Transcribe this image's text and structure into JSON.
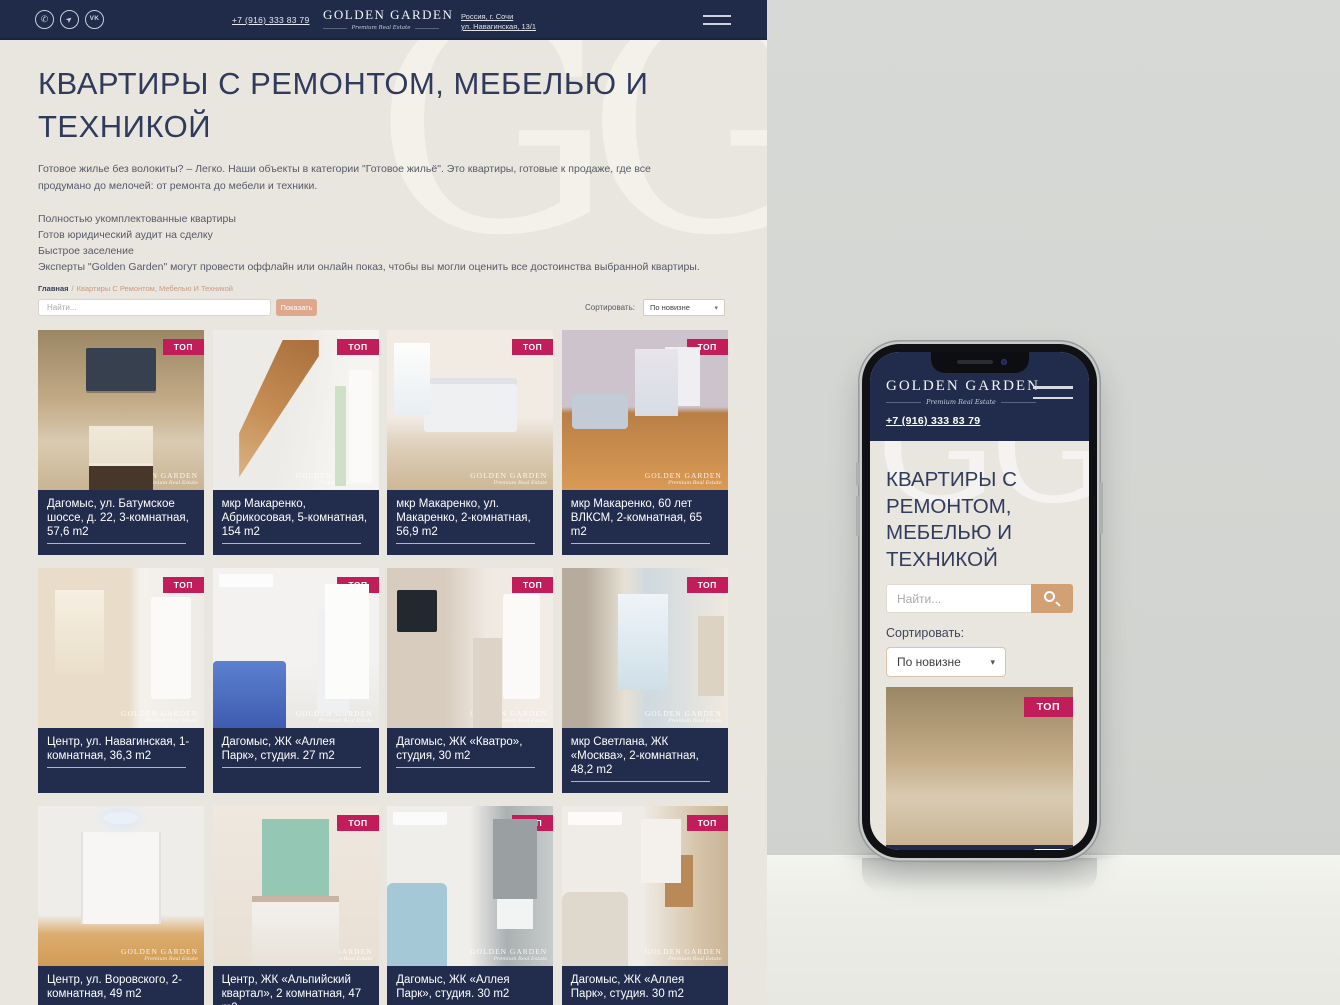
{
  "header": {
    "phone": "+7 (916) 333 83 79",
    "logo_title": "GOLDEN GARDEN",
    "logo_subtitle": "Premium Real Estate",
    "address_line1": "Россия, г. Сочи",
    "address_line2": "ул. Навагинская, 13/1",
    "social": [
      {
        "name": "whatsapp-icon",
        "glyph": "✆"
      },
      {
        "name": "telegram-icon",
        "glyph": "➤"
      },
      {
        "name": "vk-icon",
        "glyph": "VK"
      }
    ]
  },
  "watermark": {
    "letters": "GG"
  },
  "page": {
    "title": "КВАРТИРЫ С РЕМОНТОМ, МЕБЕЛЬЮ И ТЕХНИКОЙ",
    "intro": "Готовое жилье без волокиты? – Легко. Наши объекты в категории \"Готовое жильё\". Это квартиры, готовые к продаже, где все продумано до мелочей: от ремонта до мебели и техники.",
    "features": [
      "Полностью укомплектованные квартиры",
      "Готов юридический аудит на сделку",
      "Быстрое заселение",
      "Эксперты \"Golden Garden\" могут провести оффлайн или онлайн показ, чтобы вы могли оценить все достоинства выбранной квартиры."
    ],
    "breadcrumb": {
      "home": "Главная",
      "sep": "/",
      "current": "Квартиры С Ремонтом, Мебелью И Техникой"
    }
  },
  "filters": {
    "search_placeholder": "Найти...",
    "show_button": "Показать",
    "sort_label": "Сортировать:",
    "sort_value": "По новизне",
    "chevron": "▾"
  },
  "photo_watermark": {
    "line1": "GOLDEN GARDEN",
    "line2": "Premium Real Estate"
  },
  "cards": [
    {
      "title": "Дагомыс, ул. Батумское шоссе, д. 22, 3-комнатная, 57,6 m2",
      "badge": "ТОП"
    },
    {
      "title": "мкр Макаренко, Абрикосовая, 5-комнатная, 154 m2",
      "badge": "ТОП"
    },
    {
      "title": "мкр Макаренко, ул. Макаренко, 2-комнатная, 56,9 m2",
      "badge": "ТОП"
    },
    {
      "title": "мкр Макаренко, 60 лет ВЛКСМ, 2-комнатная, 65 m2",
      "badge": "ТОП"
    },
    {
      "title": "Центр, ул. Навагинская, 1-комнатная, 36,3 m2",
      "badge": "ТОП"
    },
    {
      "title": "Дагомыс, ЖК «Аллея Парк», студия. 27 m2",
      "badge": "ТОП"
    },
    {
      "title": "Дагомыс, ЖК «Кватро», студия, 30 m2",
      "badge": "ТОП"
    },
    {
      "title": "мкр Светлана, ЖК «Москва», 2-комнатная, 48,2 m2",
      "badge": "ТОП"
    },
    {
      "title": "Центр, ул. Воровского, 2-комнатная, 49 m2",
      "badge": ""
    },
    {
      "title": "Центр, ЖК «Альпийский квартал», 2 комнатная, 47 m2",
      "badge": "ТОП"
    },
    {
      "title": "Дагомыс, ЖК «Аллея Парк», студия. 30 m2",
      "badge": "ТОП"
    },
    {
      "title": "Дагомыс, ЖК «Аллея Парк», студия. 30 m2",
      "badge": "ТОП"
    }
  ],
  "colors": {
    "navy": "#212C4C",
    "beige_background": "#E9E5DF",
    "badge_crimson": "#C01D5A",
    "show_button_tan": "#DFA88C",
    "mobile_button_tan": "#D2A173",
    "breadcrumb_tan": "#C89B82"
  }
}
